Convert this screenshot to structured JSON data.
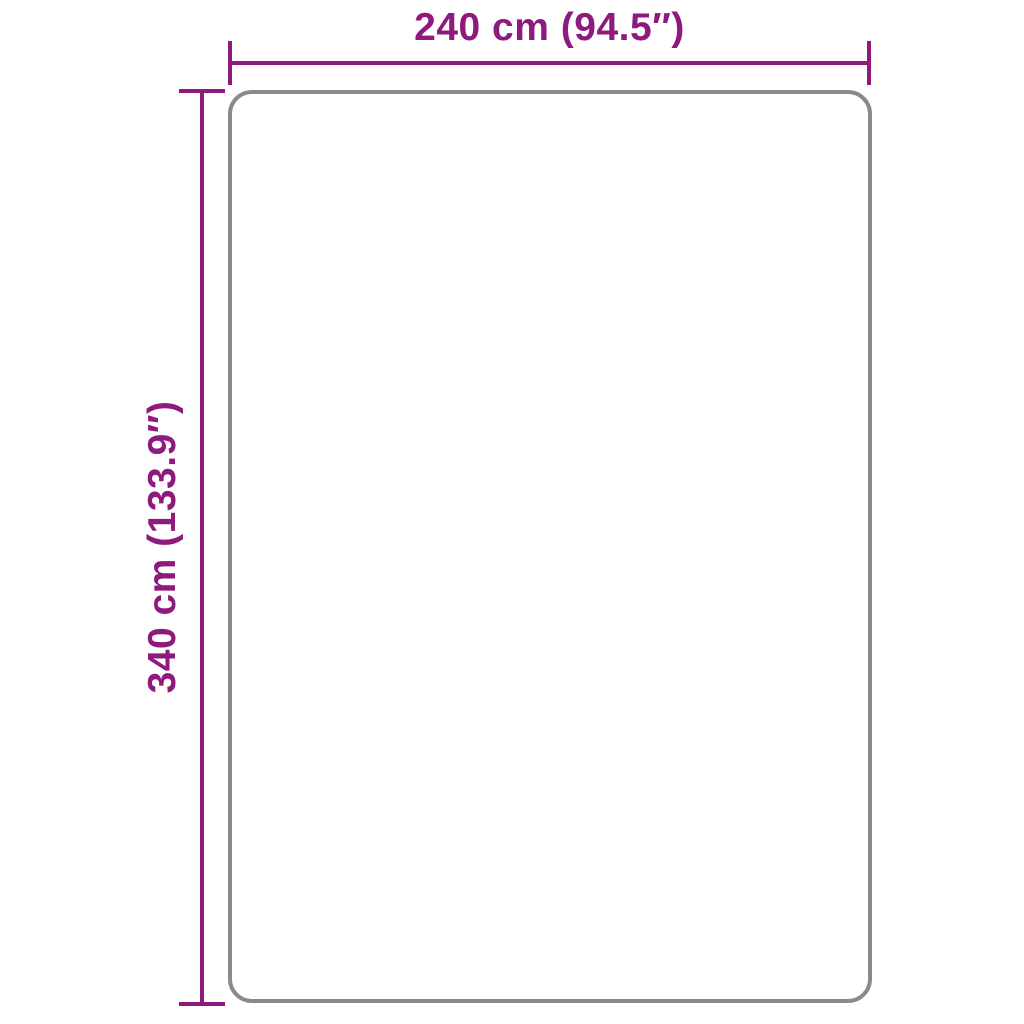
{
  "diagram": {
    "type": "product-dimension-drawing",
    "width_label": "240 cm (94.5″)",
    "height_label": "340 cm (133.9″)",
    "width_cm": 240,
    "width_inches": 94.5,
    "height_cm": 340,
    "height_inches": 133.9,
    "accent_color": "#8d1a7c",
    "outline_color": "#8a8a8a",
    "background_color": "#ffffff"
  }
}
